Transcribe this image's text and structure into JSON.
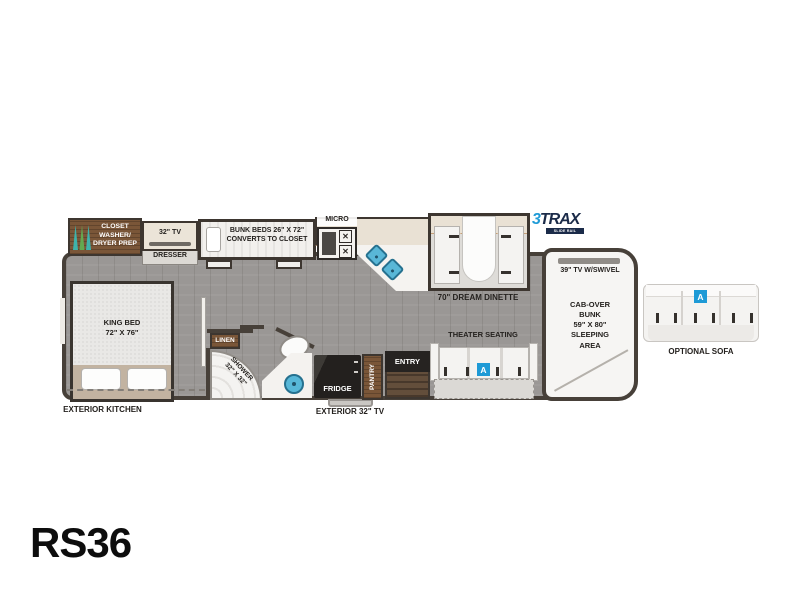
{
  "model": "RS36",
  "logo": {
    "three": "3",
    "trax": "TRAX",
    "tagline": "SLIDE RAIL SYSTEM"
  },
  "labels": {
    "closet": "CLOSET\nWASHER/\nDRYER PREP",
    "tv32": "32\" TV",
    "dresser": "DRESSER",
    "bunk_beds": "BUNK BEDS 26\" X 72\"\nCONVERTS TO CLOSET",
    "micro": "MICRO",
    "dinette": "70\" DREAM DINETTE",
    "king_bed": "KING BED\n72\" X 76\"",
    "linen": "LINEN",
    "shower": "SHOWER\n32\" X 32\"",
    "fridge": "FRIDGE",
    "pantry": "PANTRY",
    "entry": "ENTRY",
    "theater_seating": "THEATER SEATING",
    "tv39": "39\" TV W/SWIVEL",
    "cab_over_bunk": "CAB-OVER\nBUNK\n59\" X 80\"\nSLEEPING\nAREA",
    "exterior_kitchen": "EXTERIOR KITCHEN",
    "exterior_tv": "EXTERIOR 32\" TV",
    "optional_sofa": "OPTIONAL SOFA",
    "option_badge": "A"
  },
  "colors": {
    "accent_blue": "#1e9ad6",
    "sink_blue": "#57b7d8",
    "wall": "#474039",
    "wood": "#7a5638",
    "floor": "#9a9795",
    "counter_beige": "#e9e1d4"
  }
}
